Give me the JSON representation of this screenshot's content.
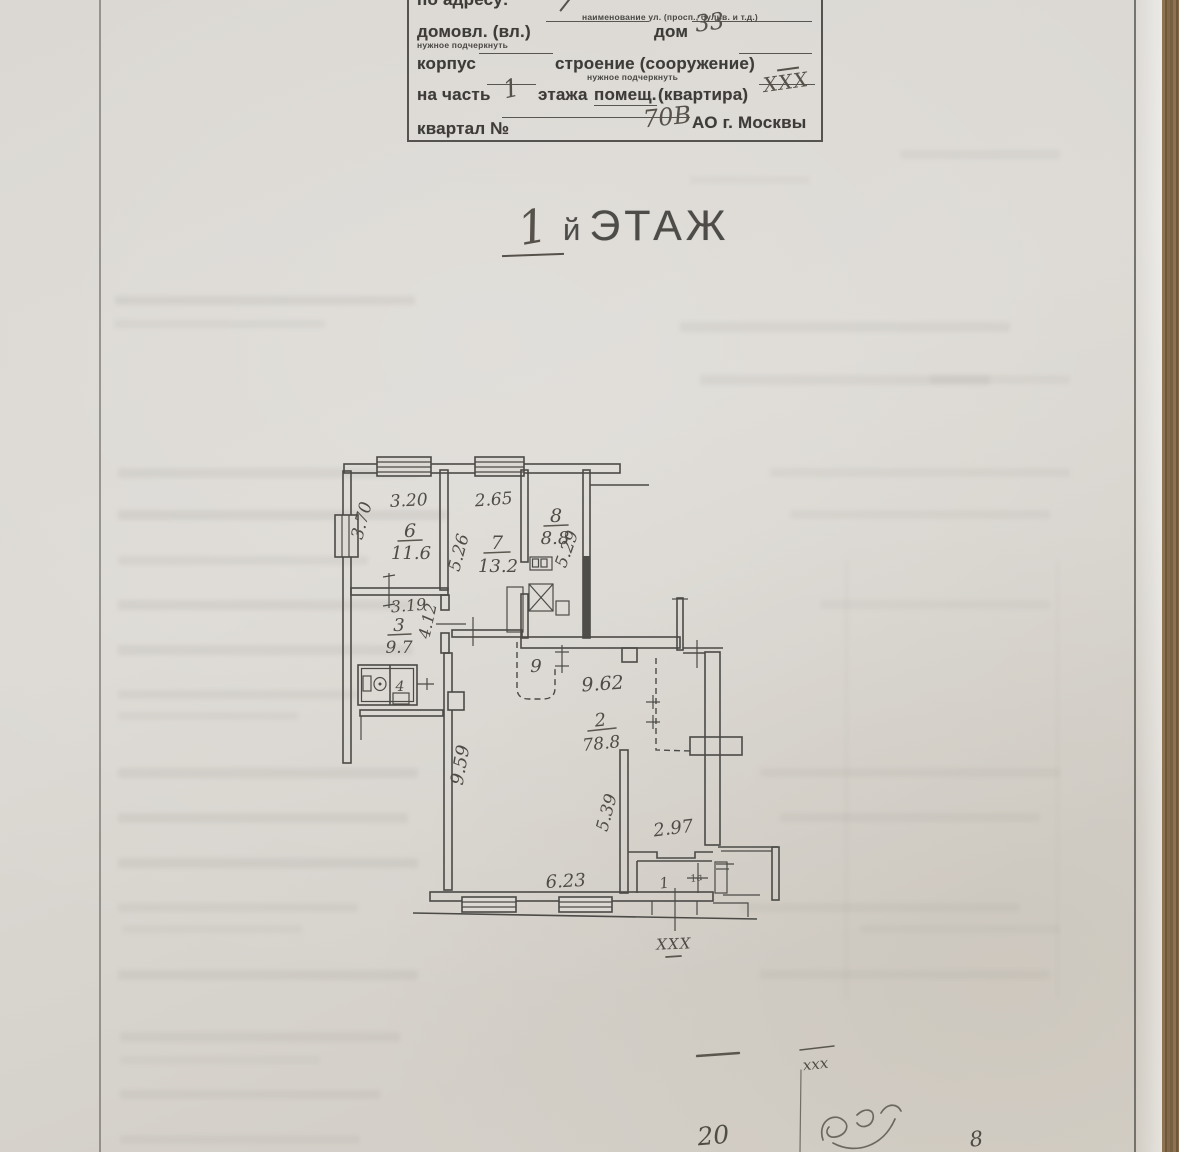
{
  "form": {
    "address_label": "по адресу:",
    "address_sub": "наименование ул. (просп., бульв. и т.д.)",
    "line2": {
      "left": "домовл. (вл.)",
      "sub": "нужное подчеркнуть",
      "mid": "дом",
      "house_value": "33"
    },
    "line3": {
      "left": "корпус",
      "mid": "строение (сооружение)",
      "sub": "нужное подчеркнуть"
    },
    "line4": {
      "left": "на часть",
      "floor_value": "1",
      "mid": "этажа",
      "opt": "помещ.",
      "mid2": "(квартира)",
      "apt_value": "XXX"
    },
    "line5": {
      "left": "квартал №",
      "kvartal_value": "70В",
      "right": "АО г. Москвы"
    }
  },
  "title": {
    "number": "1",
    "suffix_small": "й",
    "suffix": "ЭТАЖ"
  },
  "plan": {
    "rooms": {
      "r6": {
        "num": "6",
        "area": "11.6"
      },
      "r7": {
        "num": "7",
        "area": "13.2"
      },
      "r8": {
        "num": "8",
        "area": "8.8"
      },
      "r3": {
        "num": "3",
        "area": "9.7"
      },
      "r4": {
        "num": "4"
      },
      "r9": {
        "num": "9"
      },
      "r2": {
        "num": "2",
        "area": "78.8"
      },
      "r1": {
        "num": "1",
        "annex": "1а"
      }
    },
    "dims": {
      "top6": "3.20",
      "left6": "3.70",
      "top7": "2.65",
      "side7": "5.26",
      "side8": "5.29",
      "top3": "3.19",
      "side_corr": "4.12",
      "hall": "9.62",
      "corridor": "9.59",
      "side2": "5.39",
      "entry": "2.97",
      "bottom": "6.23"
    },
    "xxx_mark": "XXX"
  },
  "notes": {
    "xxx": "xxx",
    "left_number": "20",
    "right_number": "8"
  }
}
